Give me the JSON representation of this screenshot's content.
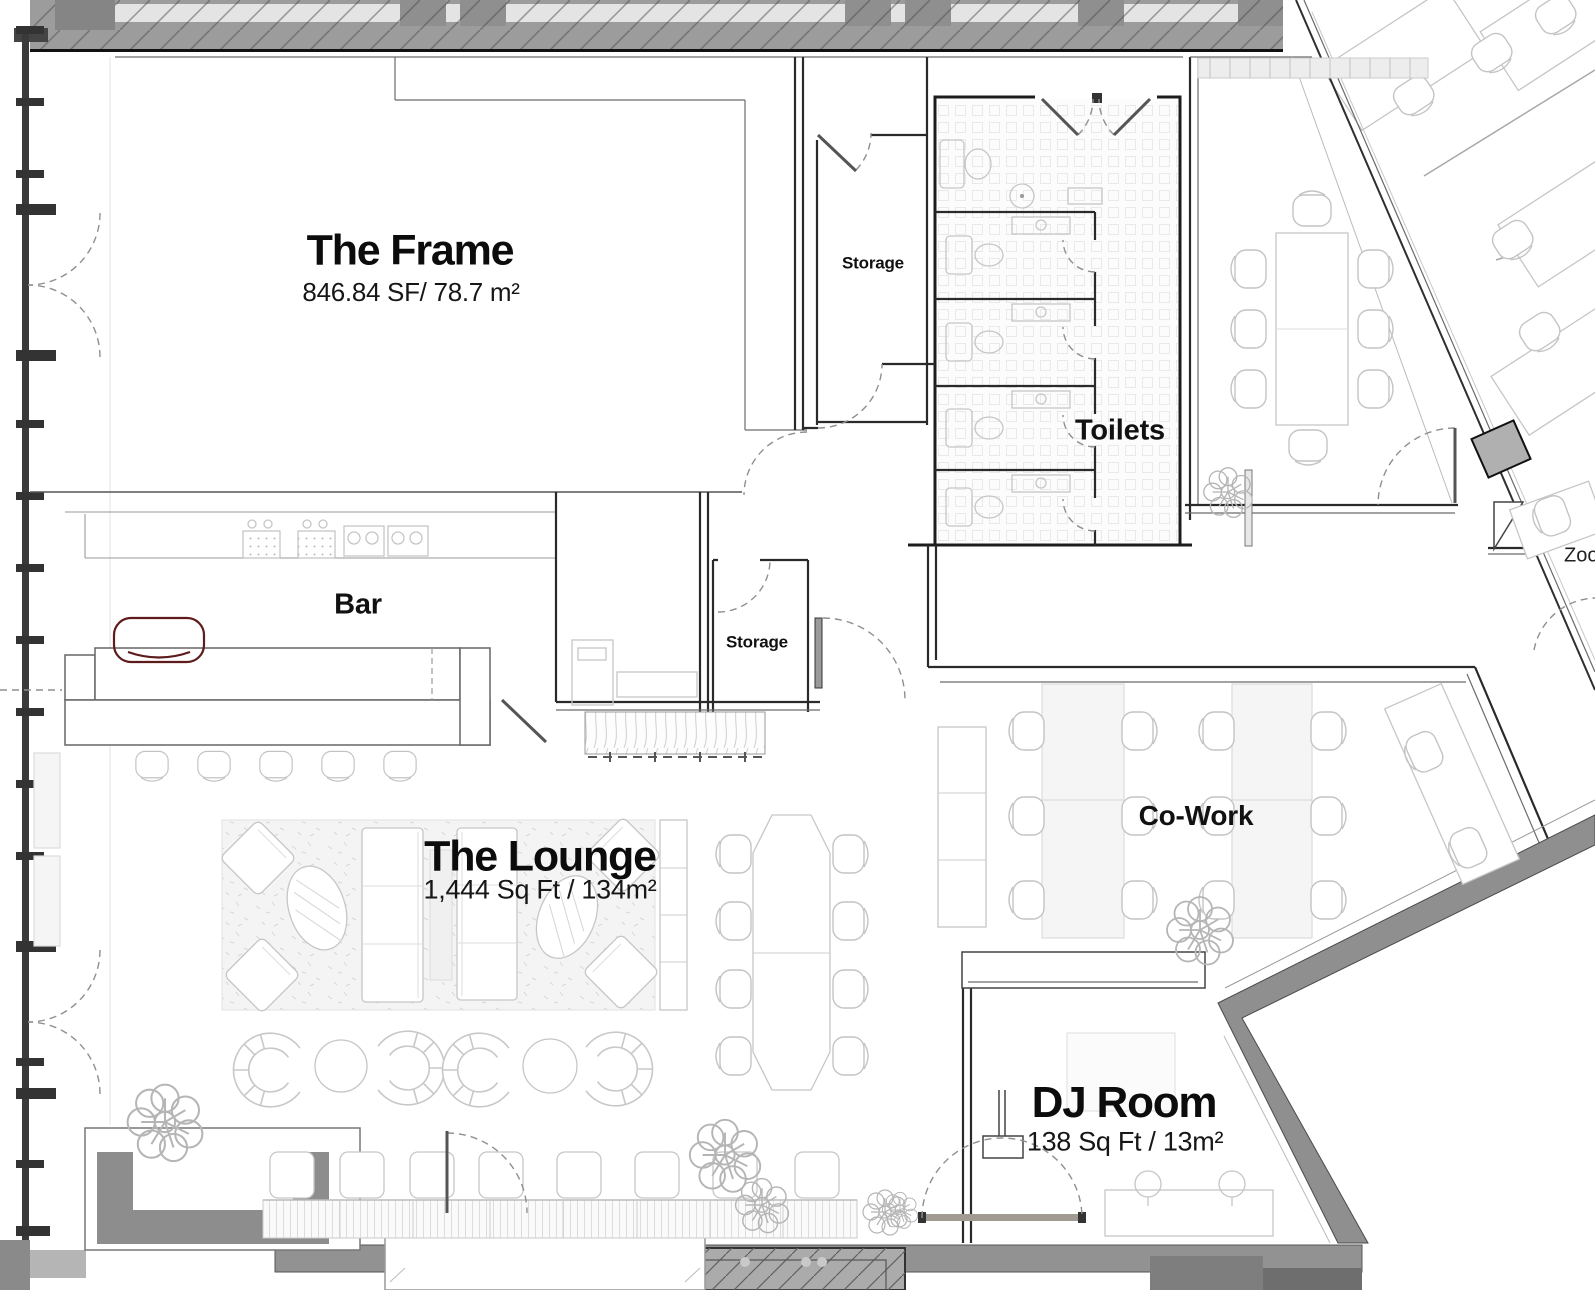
{
  "rooms": {
    "the_frame": {
      "label": "The Frame",
      "area": "846.84 SF/ 78.7 m²"
    },
    "bar": {
      "label": "Bar"
    },
    "storage_top": {
      "label": "Storage"
    },
    "storage_mid": {
      "label": "Storage"
    },
    "toilets": {
      "label": "Toilets"
    },
    "the_lounge": {
      "label": "The Lounge",
      "area": "1,444 Sq Ft / 134m²"
    },
    "cowork": {
      "label": "Co-Work"
    },
    "dj_room": {
      "label": "DJ Room",
      "area": "138 Sq Ft / 13m²"
    },
    "zoom_room": {
      "label": "Zoo"
    }
  },
  "colors": {
    "background": "#ffffff",
    "exterior_wall_gray": "#979797",
    "structure_gray": "#8f8f8f",
    "line_dark": "#1d1d1d",
    "furniture_line": "#c6c6c6",
    "accent_chair_outline": "#5d1b1b",
    "label_text": "#0a0a0a"
  }
}
